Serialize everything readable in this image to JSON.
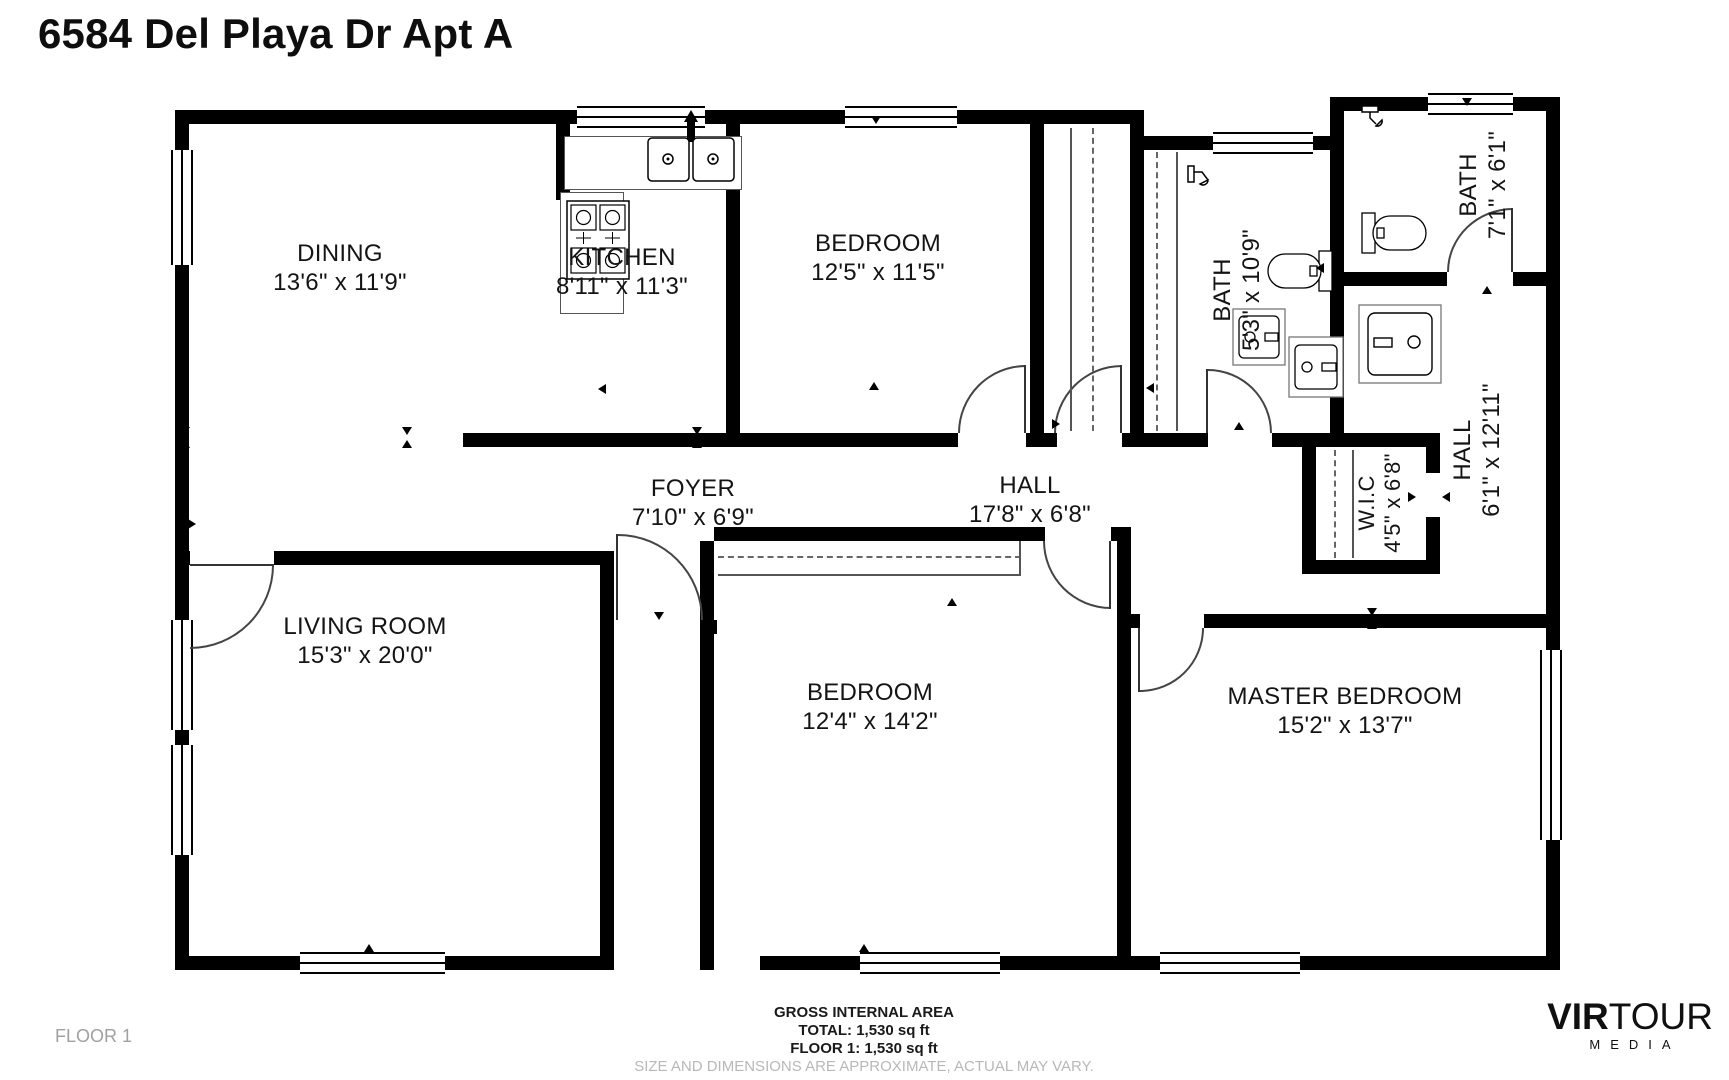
{
  "title": "6584 Del Playa Dr Apt A",
  "rooms": {
    "dining": {
      "name": "DINING",
      "dims": "13'6\" x 11'9\""
    },
    "kitchen": {
      "name": "KITCHEN",
      "dims": "8'11\" x 11'3\""
    },
    "bedroom_top": {
      "name": "BEDROOM",
      "dims": "12'5\" x 11'5\""
    },
    "bath_main": {
      "name": "BATH",
      "dims": "5'3\" x 10'9\""
    },
    "bath_small": {
      "name": "BATH",
      "dims": "7'1\" x 6'1\""
    },
    "hall_side": {
      "name": "HALL",
      "dims": "6'1\" x 12'11\""
    },
    "wic": {
      "name": "W.I.C",
      "dims": "4'5\" x 6'8\""
    },
    "foyer": {
      "name": "FOYER",
      "dims": "7'10\" x 6'9\""
    },
    "hall_main": {
      "name": "HALL",
      "dims": "17'8\" x 6'8\""
    },
    "living": {
      "name": "LIVING ROOM",
      "dims": "15'3\" x 20'0\""
    },
    "bedroom_bottom": {
      "name": "BEDROOM",
      "dims": "12'4\" x 14'2\""
    },
    "master": {
      "name": "MASTER BEDROOM",
      "dims": "15'2\" x 13'7\""
    }
  },
  "footer": {
    "floor_label": "FLOOR 1",
    "gross_area_title": "GROSS INTERNAL AREA",
    "total": "TOTAL: 1,530 sq ft",
    "floor_total": "FLOOR 1: 1,530 sq ft",
    "disclaimer": "SIZE AND DIMENSIONS ARE APPROXIMATE, ACTUAL MAY VARY."
  },
  "branding": {
    "logo_bold": "VIR",
    "logo_light": "TOUR",
    "logo_sub": "MEDIA"
  },
  "colors": {
    "wall": "#000000",
    "label": "#141414",
    "muted": "#a0a0a0",
    "disclaimer": "#b8b8b8"
  }
}
